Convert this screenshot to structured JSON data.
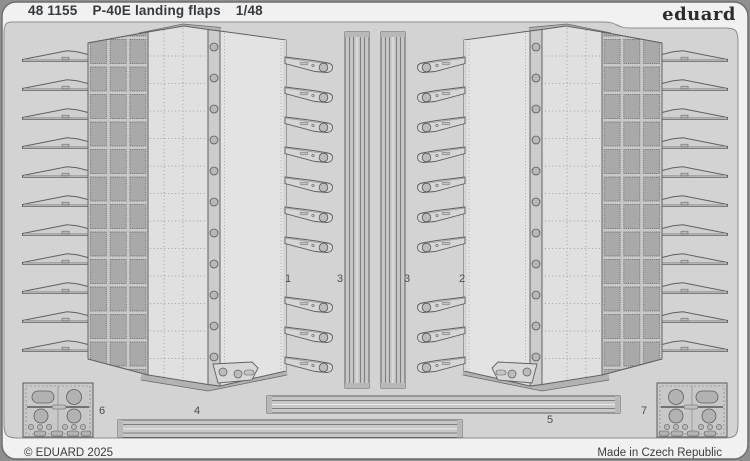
{
  "header": {
    "catalog_number": "48 1155",
    "title": "P-40E landing flaps",
    "scale": "1/48"
  },
  "brand": {
    "logo_text": "eduard"
  },
  "sheet": {
    "part_labels": [
      {
        "text": "1"
      },
      {
        "text": "3"
      },
      {
        "text": "3"
      },
      {
        "text": "2"
      },
      {
        "text": "4"
      },
      {
        "text": "5"
      },
      {
        "text": "6"
      },
      {
        "text": "7"
      }
    ]
  },
  "footer": {
    "copyright": "© EDUARD 2025",
    "origin": "Made in Czech Republic"
  },
  "colors": {
    "outside_background": "#8f8f8f",
    "sheet_margin": "#f1f1f1",
    "fret_background": "#d3d3d3",
    "part_fill_light": "#e0e0e0",
    "part_fill_medium": "#c8c8c8",
    "part_fill_dark": "#a9a9a9",
    "outline": "#5f5f5f",
    "text": "#35393d"
  }
}
